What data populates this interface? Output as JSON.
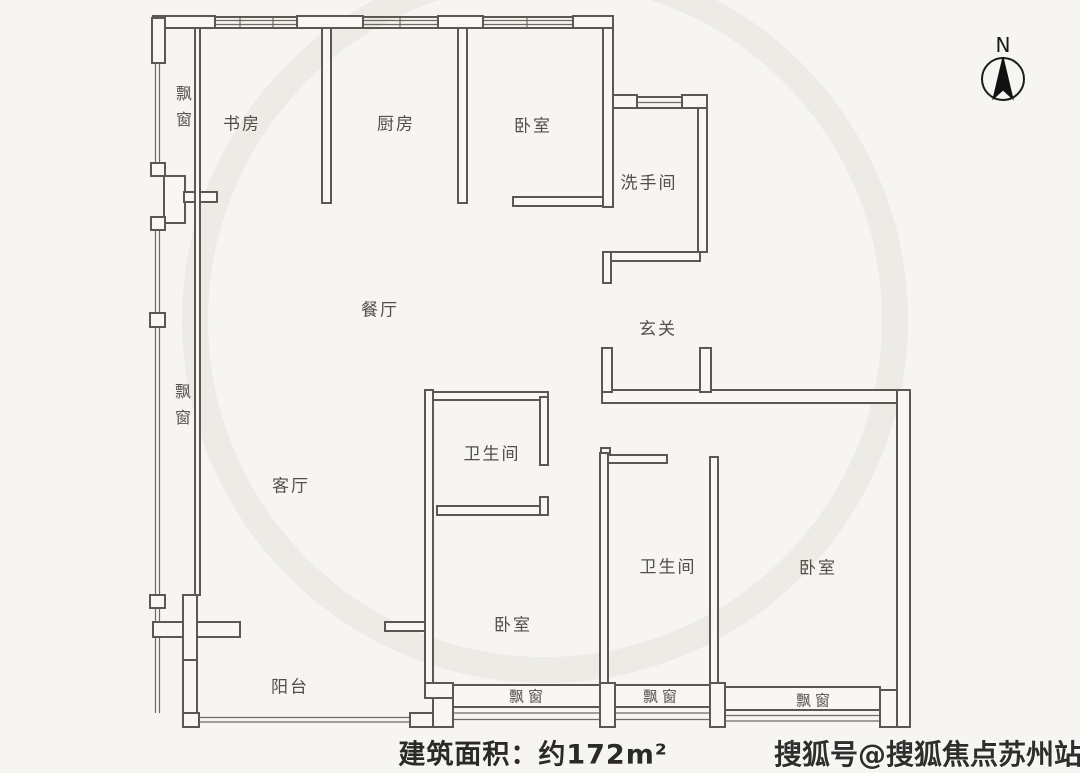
{
  "colors": {
    "background": "#f6f5f2",
    "wall_line": "#5b5751",
    "label_text": "#524f49",
    "footer_text": "#2b2a27",
    "watermark_text": "#2f2e2c"
  },
  "compass": {
    "label": "N"
  },
  "rooms": {
    "study": "书房",
    "kitchen": "厨房",
    "bedroom_top": "卧室",
    "washroom": "洗手间",
    "dining": "餐厅",
    "entry": "玄关",
    "bathroom_main": "卫生间",
    "living": "客厅",
    "bathroom_second": "卫生间",
    "bedroom_center": "卧室",
    "bedroom_right": "卧室",
    "balcony": "阳台"
  },
  "bay_windows": {
    "left_top": "飘窗",
    "left_mid": "飘窗",
    "bottom_center": "飘窗",
    "bottom_middle": "飘窗",
    "bottom_right": "飘窗"
  },
  "footer": {
    "area_text": "建筑面积：约172m²"
  },
  "watermark": {
    "text": "搜狐号@搜狐焦点苏州站"
  }
}
